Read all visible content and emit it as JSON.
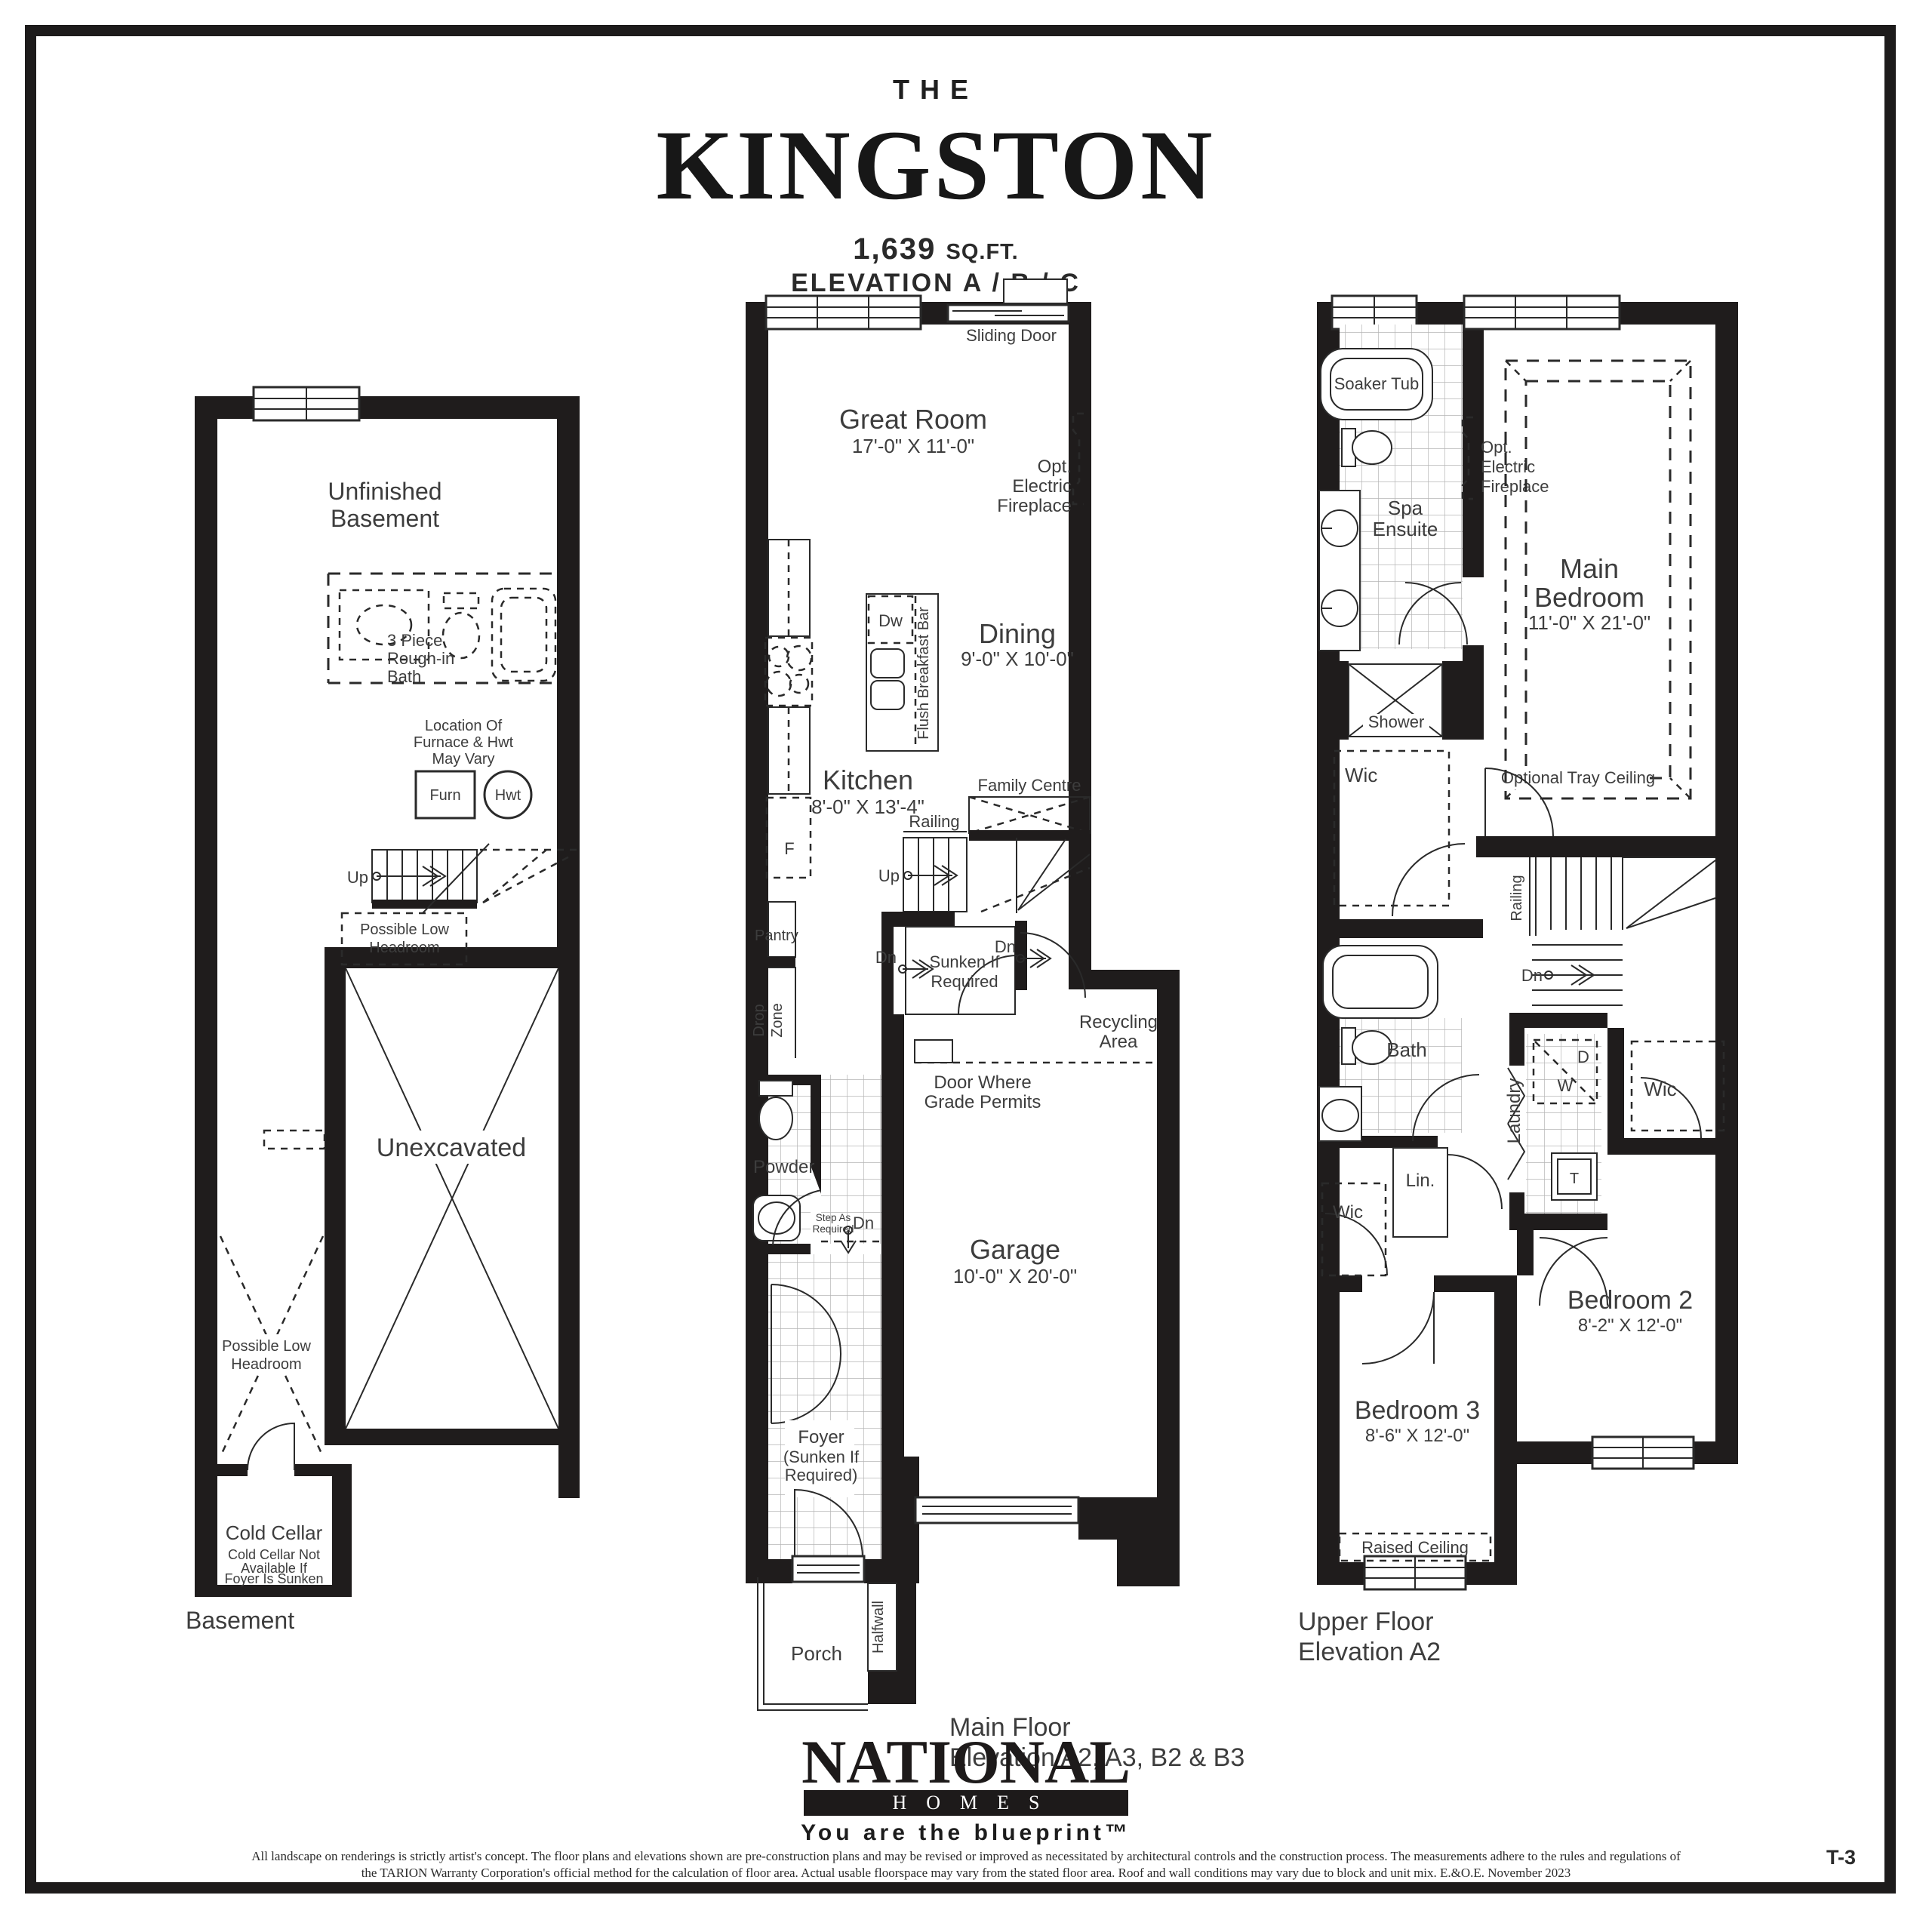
{
  "title": {
    "the": "THE",
    "name": "KINGSTON",
    "sqft_value": "1,639",
    "sqft_unit": "SQ.FT.",
    "elevation": "ELEVATION A / B / C"
  },
  "basement": {
    "caption": "Basement",
    "unfinished_l1": "Unfinished",
    "unfinished_l2": "Basement",
    "bath_l1": "3 Piece",
    "bath_l2": "Rough-in",
    "bath_l3": "Bath",
    "furnace_note_l1": "Location Of",
    "furnace_note_l2": "Furnace & Hwt",
    "furnace_note_l3": "May Vary",
    "furn": "Furn",
    "hwt": "Hwt",
    "up": "Up",
    "headroom_l1": "Possible Low",
    "headroom_l2": "Headroom",
    "unexcavated": "Unexcavated",
    "cold_cellar": "Cold Cellar",
    "cold_note_l1": "Cold Cellar Not",
    "cold_note_l2": "Available If",
    "cold_note_l3": "Foyer Is Sunken"
  },
  "main_floor": {
    "caption_l1": "Main Floor",
    "caption_l2": "Elevation A2, A3, B2 & B3",
    "sliding_door": "Sliding Door",
    "great_room": "Great Room",
    "great_room_dim": "17'-0\" X 11'-0\"",
    "fireplace_l1": "Opt.",
    "fireplace_l2": "Electric",
    "fireplace_l3": "Fireplace",
    "dw": "Dw",
    "flush_bar": "Flush Breakfast Bar",
    "dining": "Dining",
    "dining_dim": "9'-0\" X 10'-0\"",
    "kitchen": "Kitchen",
    "kitchen_dim": "8'-0\" X 13'-4\"",
    "fridge": "F",
    "family_centre": "Family Centre",
    "railing": "Railing",
    "up": "Up",
    "pantry": "Pantry",
    "dn": "Dn",
    "sunken_l1": "Sunken If",
    "sunken_l2": "Required",
    "drop_l1": "Drop",
    "drop_l2": "Zone",
    "recycling_l1": "Recycling",
    "recycling_l2": "Area",
    "grade_l1": "Door Where",
    "grade_l2": "Grade Permits",
    "powder": "Powder",
    "step_l1": "Step As",
    "step_l2": "Required",
    "garage": "Garage",
    "garage_dim": "10'-0\" X 20'-0\"",
    "foyer_l1": "Foyer",
    "foyer_l2": "(Sunken If",
    "foyer_l3": "Required)",
    "porch": "Porch",
    "halfwall": "Halfwall"
  },
  "upper_floor": {
    "caption_l1": "Upper Floor",
    "caption_l2": "Elevation A2",
    "soaker_tub": "Soaker Tub",
    "spa_l1": "Spa",
    "spa_l2": "Ensuite",
    "fireplace_l1": "Opt.",
    "fireplace_l2": "Electric",
    "fireplace_l3": "Fireplace",
    "main_bed_l1": "Main",
    "main_bed_l2": "Bedroom",
    "main_bed_dim": "11'-0\" X 21'-0\"",
    "shower": "Shower",
    "wic": "Wic",
    "tray": "Optional Tray Ceiling",
    "railing": "Railing",
    "dn": "Dn",
    "bath": "Bath",
    "laundry": "Laundry",
    "d": "D",
    "w": "W",
    "t": "T",
    "lin": "Lin.",
    "bed2": "Bedroom 2",
    "bed2_dim": "8'-2\" X 12'-0\"",
    "bed3": "Bedroom 3",
    "bed3_dim": "8'-6\" X 12'-0\"",
    "raised": "Raised Ceiling"
  },
  "footer": {
    "logo_main": "NATIONAL",
    "logo_homes": "HOMES",
    "tagline": "You are the blueprint™",
    "disclaimer_line1": "All landscape on renderings is strictly artist's concept. The floor plans and elevations shown are pre-construction plans and may be revised or improved as necessitated by architectural controls and the construction process. The measurements adhere to the rules and regulations of",
    "disclaimer_line2": "the TARION Warranty Corporation's official method for the calculation of floor area. Actual usable floorspace may vary from the stated floor area. Roof and wall conditions may vary due to block and unit mix.  E.&O.E. November 2023",
    "sheet_no": "T-3"
  }
}
